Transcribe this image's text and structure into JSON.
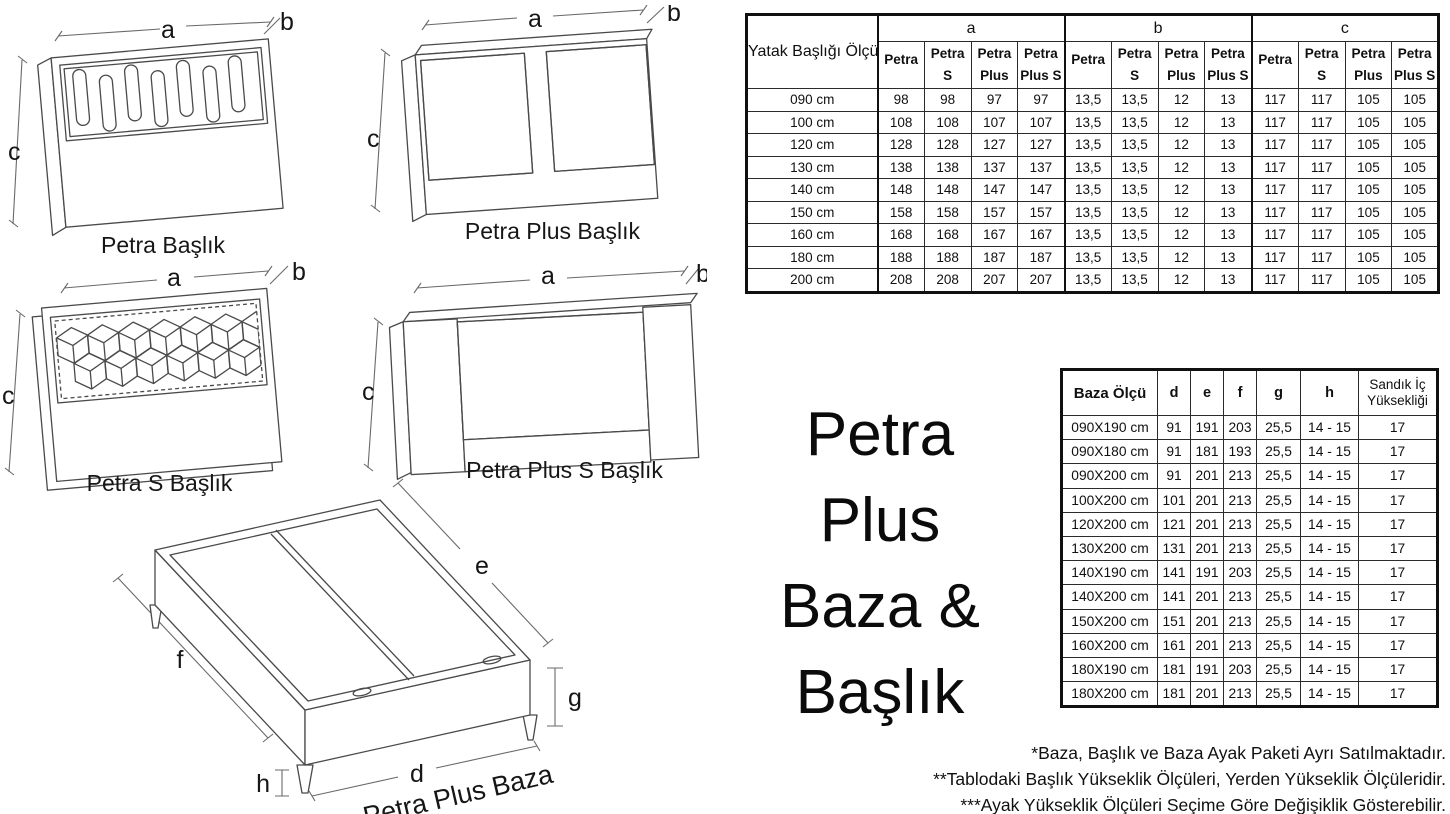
{
  "title": {
    "lines": [
      "Petra",
      "Plus",
      "Baza & Başlık"
    ]
  },
  "dim_labels": {
    "a": "a",
    "b": "b",
    "c": "c",
    "d": "d",
    "e": "e",
    "f": "f",
    "g": "g",
    "h": "h"
  },
  "drawings": [
    {
      "label": "Petra Başlık"
    },
    {
      "label": "Petra Plus Başlık"
    },
    {
      "label": "Petra S Başlık"
    },
    {
      "label": "Petra Plus S Başlık"
    },
    {
      "label": "Petra Plus Baza"
    }
  ],
  "headboard_table": {
    "corner_header": "Yatak Başlığı Ölçü",
    "groups": [
      "a",
      "b",
      "c"
    ],
    "variants": [
      {
        "line1": "Petra",
        "line2": ""
      },
      {
        "line1": "Petra",
        "line2": "S"
      },
      {
        "line1": "Petra",
        "line2": "Plus"
      },
      {
        "line1": "Petra",
        "line2": "Plus S"
      }
    ],
    "rows": [
      {
        "size": "090 cm",
        "a": [
          "98",
          "98",
          "97",
          "97"
        ],
        "b": [
          "13,5",
          "13,5",
          "12",
          "13"
        ],
        "c": [
          "117",
          "117",
          "105",
          "105"
        ]
      },
      {
        "size": "100 cm",
        "a": [
          "108",
          "108",
          "107",
          "107"
        ],
        "b": [
          "13,5",
          "13,5",
          "12",
          "13"
        ],
        "c": [
          "117",
          "117",
          "105",
          "105"
        ]
      },
      {
        "size": "120 cm",
        "a": [
          "128",
          "128",
          "127",
          "127"
        ],
        "b": [
          "13,5",
          "13,5",
          "12",
          "13"
        ],
        "c": [
          "117",
          "117",
          "105",
          "105"
        ]
      },
      {
        "size": "130 cm",
        "a": [
          "138",
          "138",
          "137",
          "137"
        ],
        "b": [
          "13,5",
          "13,5",
          "12",
          "13"
        ],
        "c": [
          "117",
          "117",
          "105",
          "105"
        ]
      },
      {
        "size": "140 cm",
        "a": [
          "148",
          "148",
          "147",
          "147"
        ],
        "b": [
          "13,5",
          "13,5",
          "12",
          "13"
        ],
        "c": [
          "117",
          "117",
          "105",
          "105"
        ]
      },
      {
        "size": "150 cm",
        "a": [
          "158",
          "158",
          "157",
          "157"
        ],
        "b": [
          "13,5",
          "13,5",
          "12",
          "13"
        ],
        "c": [
          "117",
          "117",
          "105",
          "105"
        ]
      },
      {
        "size": "160 cm",
        "a": [
          "168",
          "168",
          "167",
          "167"
        ],
        "b": [
          "13,5",
          "13,5",
          "12",
          "13"
        ],
        "c": [
          "117",
          "117",
          "105",
          "105"
        ]
      },
      {
        "size": "180 cm",
        "a": [
          "188",
          "188",
          "187",
          "187"
        ],
        "b": [
          "13,5",
          "13,5",
          "12",
          "13"
        ],
        "c": [
          "117",
          "117",
          "105",
          "105"
        ]
      },
      {
        "size": "200 cm",
        "a": [
          "208",
          "208",
          "207",
          "207"
        ],
        "b": [
          "13,5",
          "13,5",
          "12",
          "13"
        ],
        "c": [
          "117",
          "117",
          "105",
          "105"
        ]
      }
    ]
  },
  "baza_table": {
    "size_header": "Baza Ölçü",
    "dim_headers": [
      "d",
      "e",
      "f",
      "g",
      "h"
    ],
    "storage_header_line1": "Sandık İç",
    "storage_header_line2": "Yüksekliği",
    "rows": [
      [
        "090X190 cm",
        "91",
        "191",
        "203",
        "25,5",
        "14 - 15",
        "17"
      ],
      [
        "090X180 cm",
        "91",
        "181",
        "193",
        "25,5",
        "14 - 15",
        "17"
      ],
      [
        "090X200 cm",
        "91",
        "201",
        "213",
        "25,5",
        "14 - 15",
        "17"
      ],
      [
        "100X200 cm",
        "101",
        "201",
        "213",
        "25,5",
        "14 - 15",
        "17"
      ],
      [
        "120X200 cm",
        "121",
        "201",
        "213",
        "25,5",
        "14 - 15",
        "17"
      ],
      [
        "130X200 cm",
        "131",
        "201",
        "213",
        "25,5",
        "14 - 15",
        "17"
      ],
      [
        "140X190 cm",
        "141",
        "191",
        "203",
        "25,5",
        "14 - 15",
        "17"
      ],
      [
        "140X200 cm",
        "141",
        "201",
        "213",
        "25,5",
        "14 - 15",
        "17"
      ],
      [
        "150X200 cm",
        "151",
        "201",
        "213",
        "25,5",
        "14 - 15",
        "17"
      ],
      [
        "160X200 cm",
        "161",
        "201",
        "213",
        "25,5",
        "14 - 15",
        "17"
      ],
      [
        "180X190 cm",
        "181",
        "191",
        "203",
        "25,5",
        "14 - 15",
        "17"
      ],
      [
        "180X200 cm",
        "181",
        "201",
        "213",
        "25,5",
        "14 - 15",
        "17"
      ]
    ]
  },
  "footnotes": [
    "*Baza, Başlık ve Baza Ayak Paketi Ayrı Satılmaktadır.",
    "**Tablodaki Başlık Yükseklik Ölçüleri, Yerden Yükseklik Ölçüleridir.",
    "***Ayak Yükseklik Ölçüleri Seçime Göre Değişiklik Gösterebilir."
  ]
}
